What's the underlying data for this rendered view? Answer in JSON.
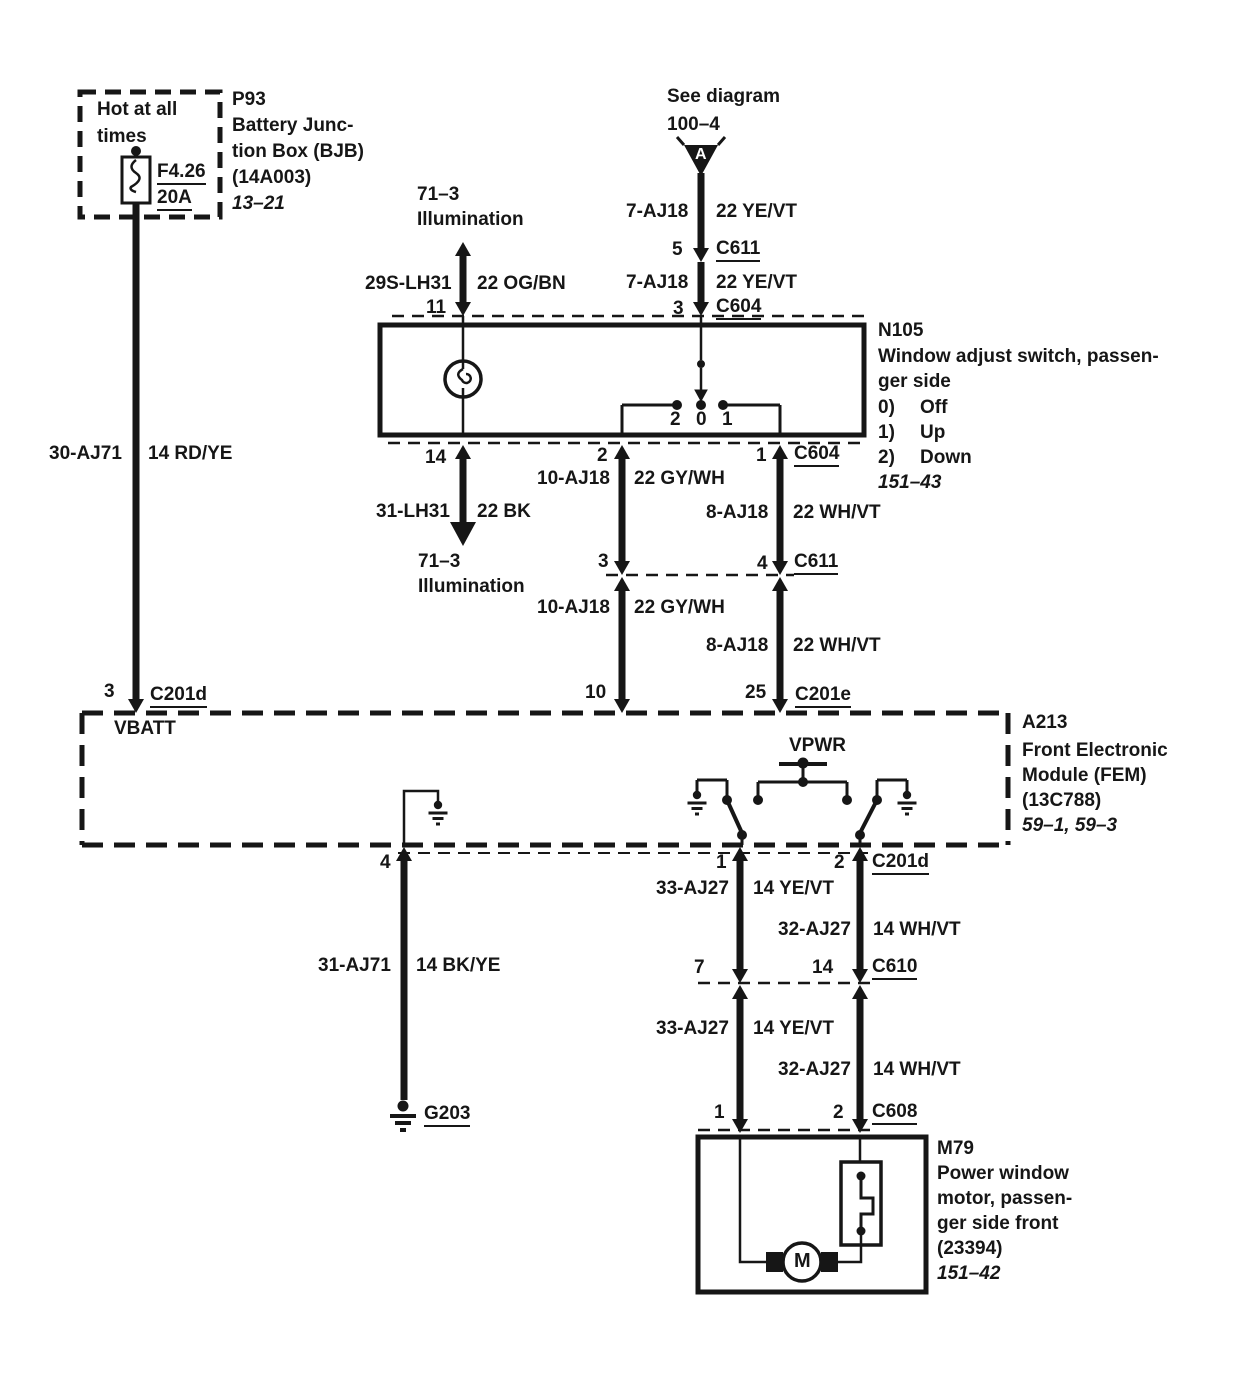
{
  "colors": {
    "ink": "#161616",
    "paper": "#ffffff"
  },
  "offpage": {
    "line1": "See diagram",
    "line2": "100–4",
    "marker": "A"
  },
  "battery_box": {
    "hot1": "Hot at all",
    "hot2": "times",
    "fuse_name": "F4.26",
    "fuse_rating": "20A",
    "id": "P93",
    "name1": "Battery Junc-",
    "name2": "tion Box (BJB)",
    "part": "(14A003)",
    "page": "13–21"
  },
  "battery_wire": {
    "circuit": "30-AJ71",
    "spec": "14 RD/YE",
    "pin": "3",
    "connector": "C201d"
  },
  "feed_upper": {
    "circuit": "7-AJ18",
    "spec": "22 YE/VT",
    "pin": "5",
    "connector": "C611"
  },
  "feed_lower": {
    "circuit": "7-AJ18",
    "spec": "22 YE/VT",
    "pin": "3",
    "connector": "C604"
  },
  "illum_in": {
    "ref1": "71–3",
    "ref2": "Illumination",
    "circuit": "29S-LH31",
    "spec": "22 OG/BN",
    "pin": "11"
  },
  "illum_out": {
    "pin": "14",
    "circuit": "31-LH31",
    "spec": "22 BK",
    "ref1": "71–3",
    "ref2": "Illumination"
  },
  "n105": {
    "id": "N105",
    "name1": "Window adjust switch, passen-",
    "name2": "ger side",
    "pos": [
      {
        "num": "0)",
        "label": "Off"
      },
      {
        "num": "1)",
        "label": "Up"
      },
      {
        "num": "2)",
        "label": "Down"
      }
    ],
    "page": "151–43",
    "sw_left": "2",
    "sw_center": "0",
    "sw_right": "1"
  },
  "c604_bottom": {
    "pin_left": "2",
    "pin_right": "1",
    "connector": "C604"
  },
  "wire_gy_upper": {
    "circuit": "10-AJ18",
    "spec": "22 GY/WH"
  },
  "wire_wh_upper": {
    "circuit": "8-AJ18",
    "spec": "22 WH/VT"
  },
  "c611_mid": {
    "pin_left": "3",
    "pin_right": "4",
    "connector": "C611"
  },
  "wire_gy_lower": {
    "circuit": "10-AJ18",
    "spec": "22 GY/WH"
  },
  "wire_wh_lower": {
    "circuit": "8-AJ18",
    "spec": "22 WH/VT"
  },
  "c201e": {
    "pin_left": "10",
    "pin_right": "25",
    "connector": "C201e"
  },
  "fem": {
    "id": "A213",
    "name1": "Front Electronic",
    "name2": "Module (FEM)",
    "part": "(13C788)",
    "page": "59–1, 59–3",
    "vbatt": "VBATT",
    "vpwr": "VPWR",
    "pin_ground": "4"
  },
  "c201d_bottom": {
    "pin_left": "1",
    "pin_right": "2",
    "connector": "C201d"
  },
  "ground_wire": {
    "circuit": "31-AJ71",
    "spec": "14 BK/YE",
    "ground": "G203"
  },
  "motor_upper": {
    "left_circuit": "33-AJ27",
    "left_spec": "14 YE/VT",
    "right_circuit": "32-AJ27",
    "right_spec": "14 WH/VT"
  },
  "c610": {
    "pin_left": "7",
    "pin_right": "14",
    "connector": "C610"
  },
  "motor_lower": {
    "left_circuit": "33-AJ27",
    "left_spec": "14 YE/VT",
    "right_circuit": "32-AJ27",
    "right_spec": "14 WH/VT"
  },
  "c608": {
    "pin_left": "1",
    "pin_right": "2",
    "connector": "C608"
  },
  "motor": {
    "id": "M79",
    "name1": "Power window",
    "name2": "motor, passen-",
    "name3": "ger side front",
    "part": "(23394)",
    "page": "151–42",
    "symbol": "M"
  }
}
